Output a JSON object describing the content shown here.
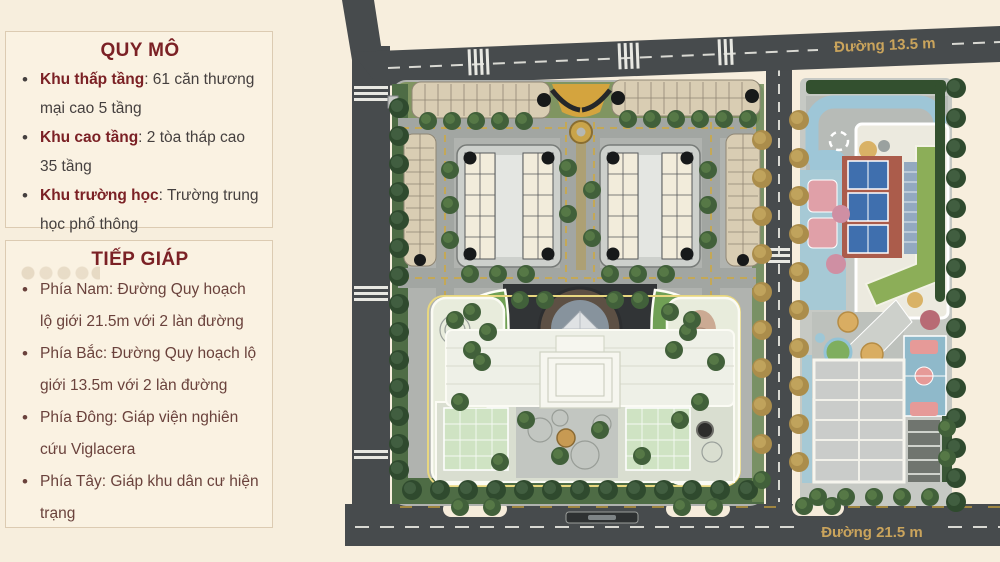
{
  "panels": {
    "quy_mo": {
      "title": "QUY MÔ",
      "items": [
        {
          "label": "Khu thấp tầng",
          "text": ": 61 căn thương mại cao 5 tầng"
        },
        {
          "label": "Khu cao tầng",
          "text": ": 2 tòa tháp cao 35 tầng"
        },
        {
          "label": "Khu trường học",
          "text": ": Trường trung học phổ thông"
        }
      ]
    },
    "tiep_giap": {
      "title": "TIẾP GIÁP",
      "items": [
        {
          "text": "Phía Nam: Đường Quy hoạch lộ giới 21.5m với 2 làn đường"
        },
        {
          "text": "Phía Bắc: Đường Quy hoạch lộ giới 13.5m với 2 làn đường"
        },
        {
          "text": "Phía Đông: Giáp viện nghiên cứu Viglacera"
        },
        {
          "text": "Phía Tây: Giáp khu dân cư hiện trạng"
        }
      ]
    }
  },
  "map": {
    "road_top_label": "Đường 13.5 m",
    "road_bottom_label": "Đường 21.5 m"
  },
  "colors": {
    "page_background": "#f7eedd",
    "panel_background": "#faf2e2",
    "panel_border": "#dccbb2",
    "heading_maroon": "#7b2125",
    "body_text": "#45403f",
    "body_text_brown": "#6a423c",
    "road": "#474b4d",
    "road_label_gold": "#caa45c",
    "water_blue": "#9ec6d7",
    "court_blue": "#3f6fae",
    "clay_red": "#ab5c4b",
    "lawn_green": "#8cae58",
    "building_tan": "#d9cdb3",
    "tree_green": "#41603a",
    "tree_gold": "#ab8d4b"
  }
}
